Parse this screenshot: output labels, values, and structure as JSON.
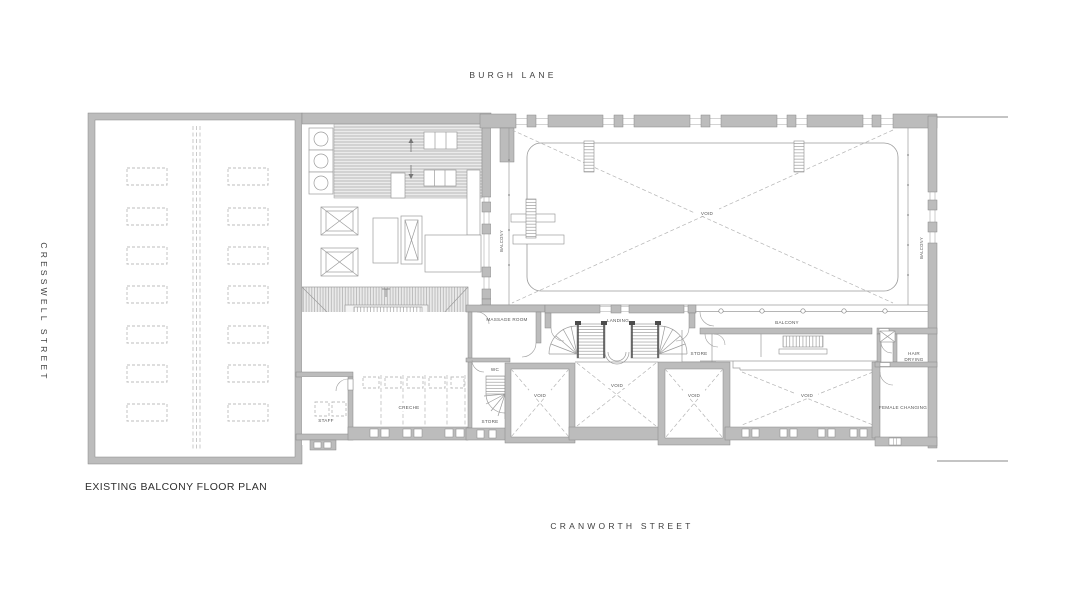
{
  "streets": {
    "top": "BURGH LANE",
    "left": "CRESSWELL STREET",
    "bottom": "CRANWORTH STREET"
  },
  "title": "EXISTING BALCONY FLOOR PLAN",
  "labels": {
    "void_main": "VOID",
    "balcony_west": "BALCONY",
    "balcony_east": "BALCONY",
    "balcony_south": "BALCONY",
    "massage_room": "MASSAGE ROOM",
    "landing": "LANDING",
    "store_landing": "STORE",
    "wc": "WC",
    "store_stair": "STORE",
    "creche": "CRECHE",
    "staff": "STAFF",
    "hair_line1": "HAIR",
    "hair_line2": "DRYING",
    "female_changing": "FEMALE CHANGING",
    "void_1": "VOID",
    "void_2": "VOID",
    "void_3": "VOID",
    "void_4": "VOID"
  },
  "colors": {
    "wall": "#bcbcbc",
    "wall_edge": "#878787",
    "line": "#9c9c9c",
    "dashed": "#b5b5b5",
    "text_dark": "#2f2f2f",
    "text_room": "#555555",
    "background": "#ffffff"
  }
}
